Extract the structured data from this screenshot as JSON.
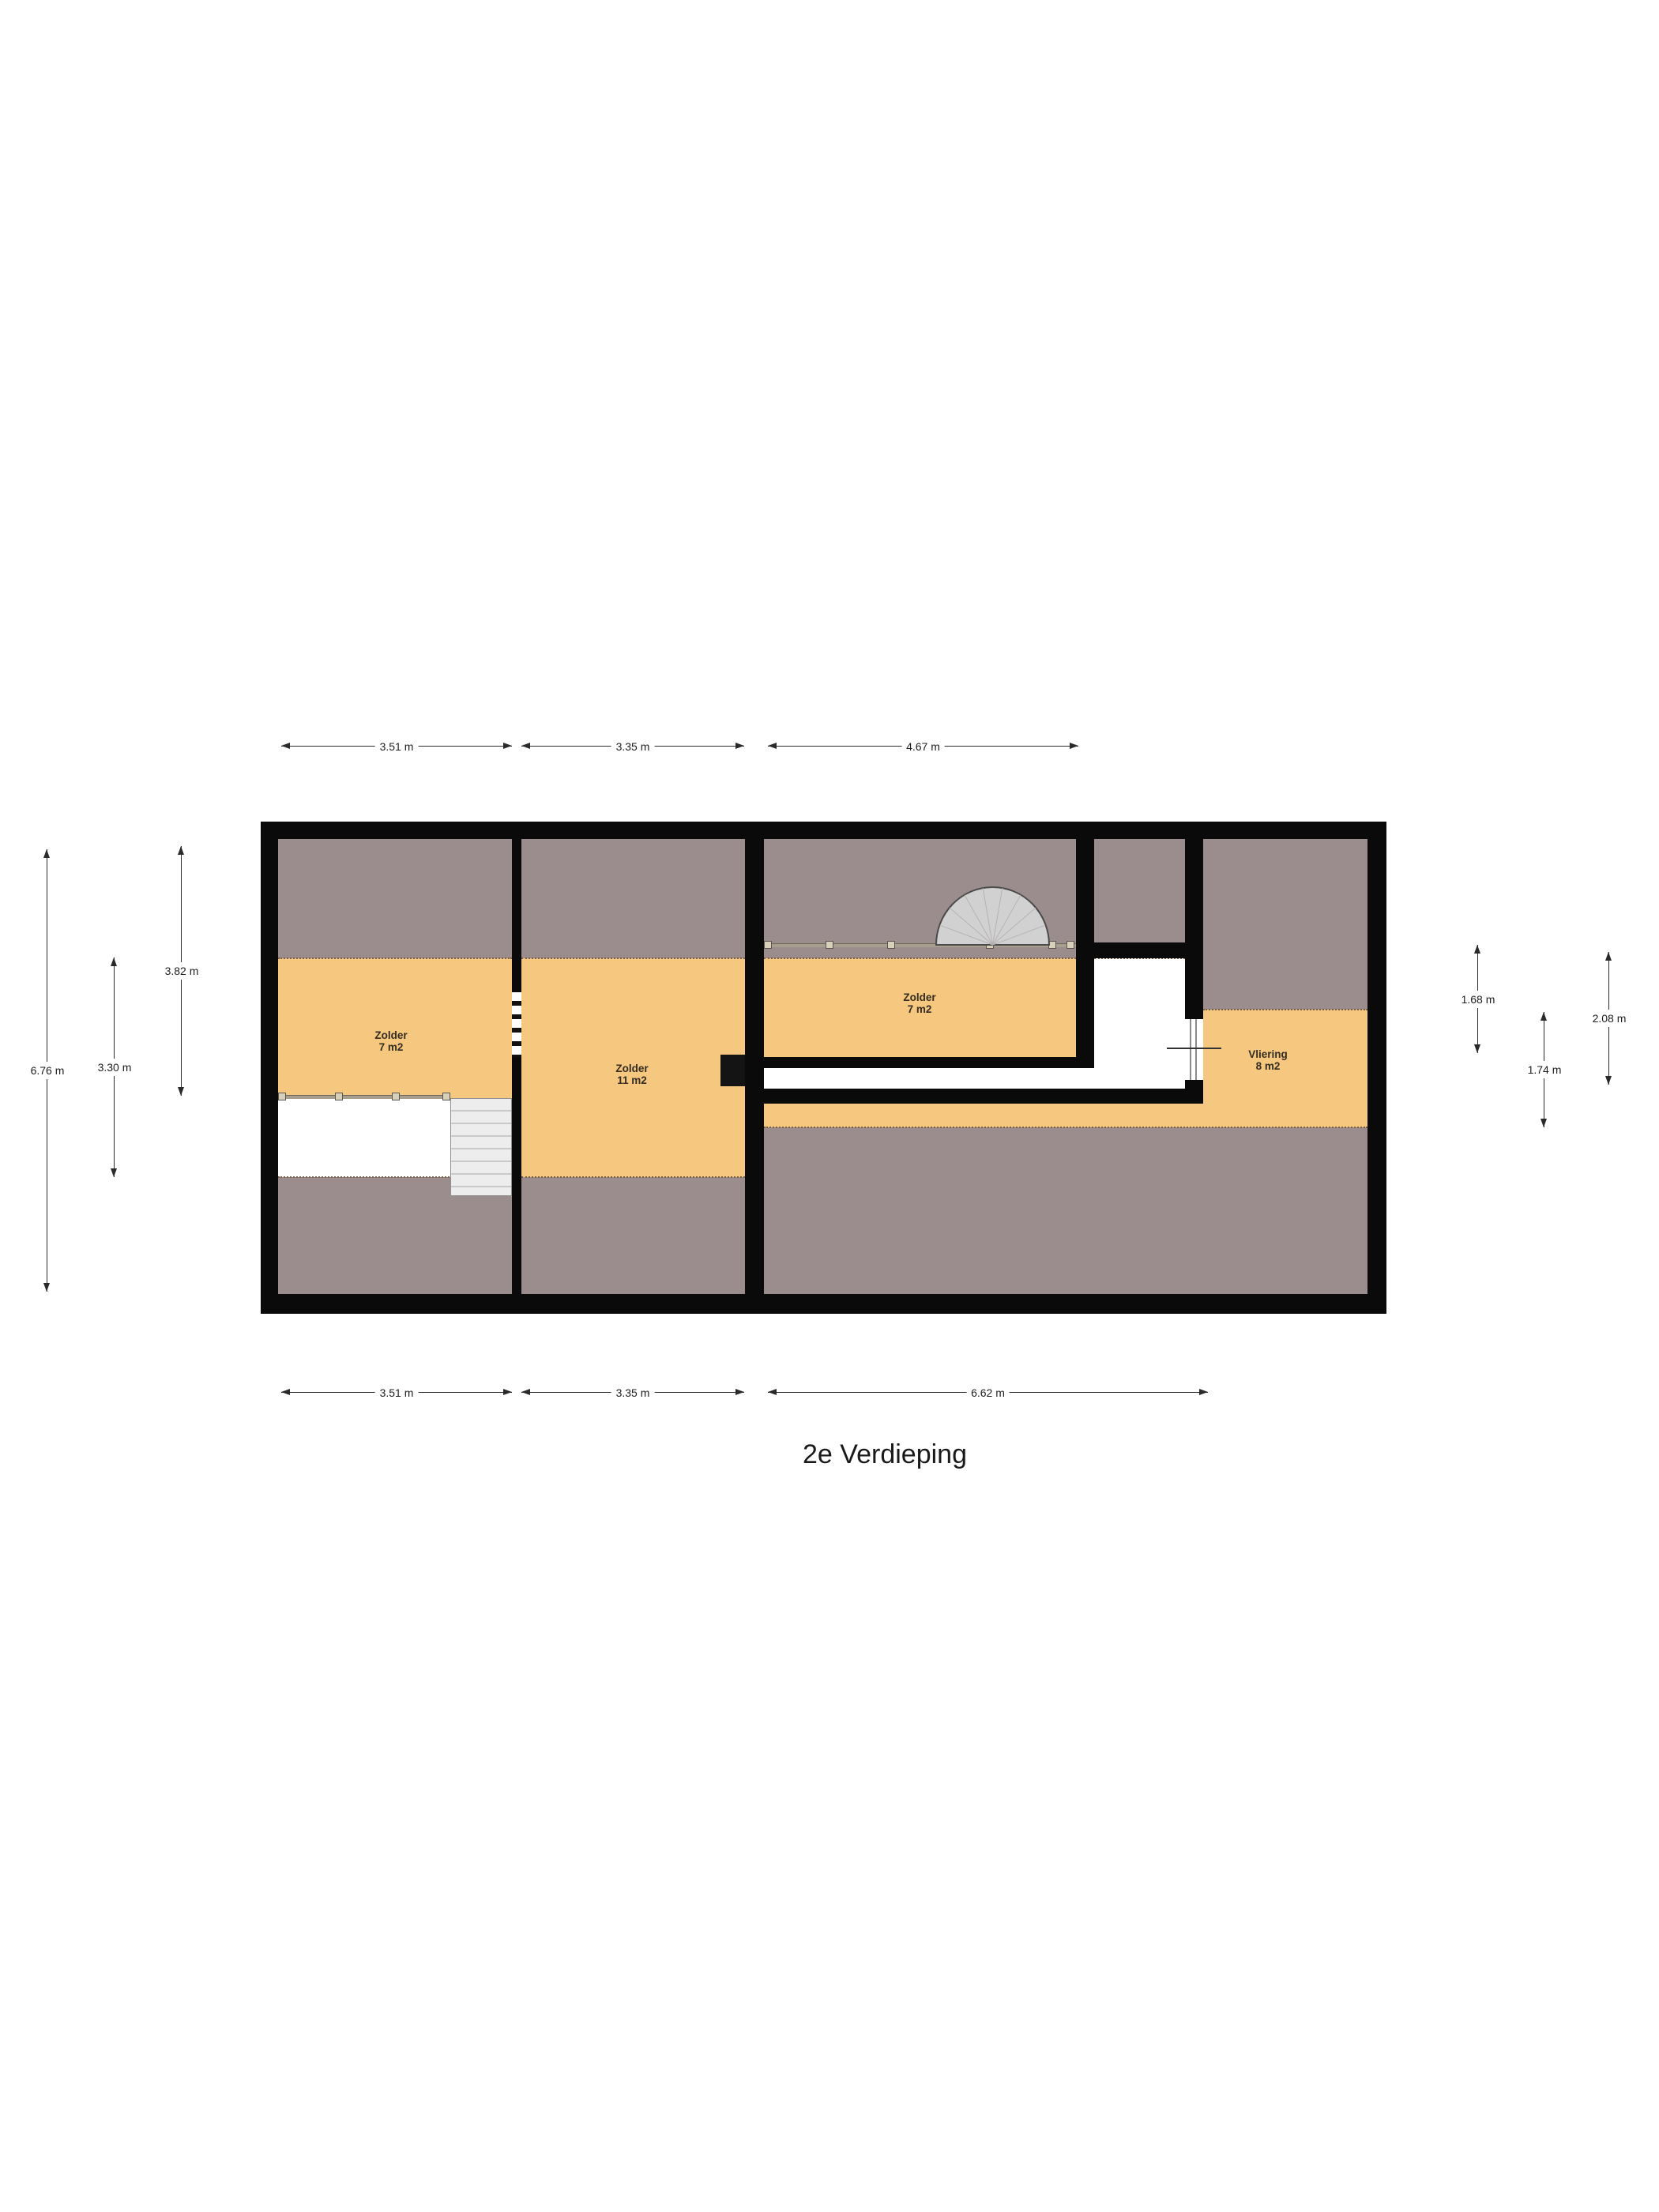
{
  "title": "2e Verdieping",
  "rooms": [
    {
      "name": "Zolder",
      "area": "7 m2"
    },
    {
      "name": "Zolder",
      "area": "11 m2"
    },
    {
      "name": "Zolder",
      "area": "7 m2"
    },
    {
      "name": "Vliering",
      "area": "8 m2"
    }
  ],
  "dimensions": {
    "top": [
      "3.51 m",
      "3.35 m",
      "4.67 m"
    ],
    "bottom": [
      "3.51 m",
      "3.35 m",
      "6.62 m"
    ],
    "left": [
      "6.76 m",
      "3.30 m",
      "3.82 m"
    ],
    "right": [
      "1.68 m",
      "1.74 m",
      "2.08 m"
    ]
  },
  "colors": {
    "floor_orange": "#f6c77e",
    "roof_slope_grey": "#9b8d8e",
    "wall_black": "#0a0a0a",
    "stair_grey": "#ededed",
    "railing_beige": "#d8d0ba"
  }
}
